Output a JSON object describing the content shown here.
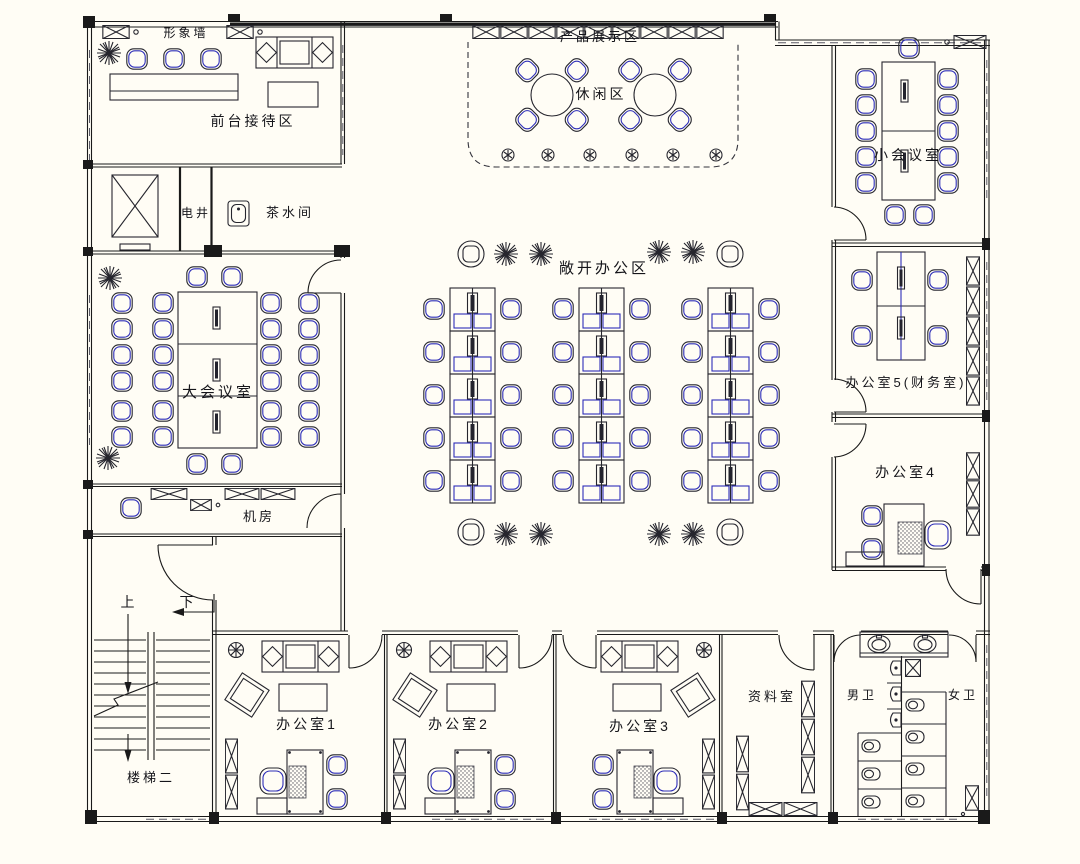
{
  "colors": {
    "background": "#fffdf5",
    "line": "#1a1a1a",
    "accent_blue": "#2e2eb8"
  },
  "rooms": {
    "image_wall": {
      "label": "形象墙"
    },
    "reception": {
      "label": "前台接待区"
    },
    "product_display": {
      "label": "产品展示区"
    },
    "leisure": {
      "label": "休闲区"
    },
    "small_meeting": {
      "label": "小会议室"
    },
    "shaft": {
      "label": "电井"
    },
    "tea": {
      "label": "茶水间"
    },
    "open_office": {
      "label": "敞开办公区"
    },
    "large_meeting": {
      "label": "大会议室"
    },
    "office5": {
      "label": "办公室5(财务室)"
    },
    "office4": {
      "label": "办公室4"
    },
    "machine": {
      "label": "机房"
    },
    "stairs": {
      "up": "上",
      "down": "下",
      "label": "楼梯二"
    },
    "office1": {
      "label": "办公室1"
    },
    "office2": {
      "label": "办公室2"
    },
    "office3": {
      "label": "办公室3"
    },
    "archive": {
      "label": "资料室"
    },
    "toilet_m": {
      "label": "男卫"
    },
    "toilet_f": {
      "label": "女卫"
    }
  }
}
